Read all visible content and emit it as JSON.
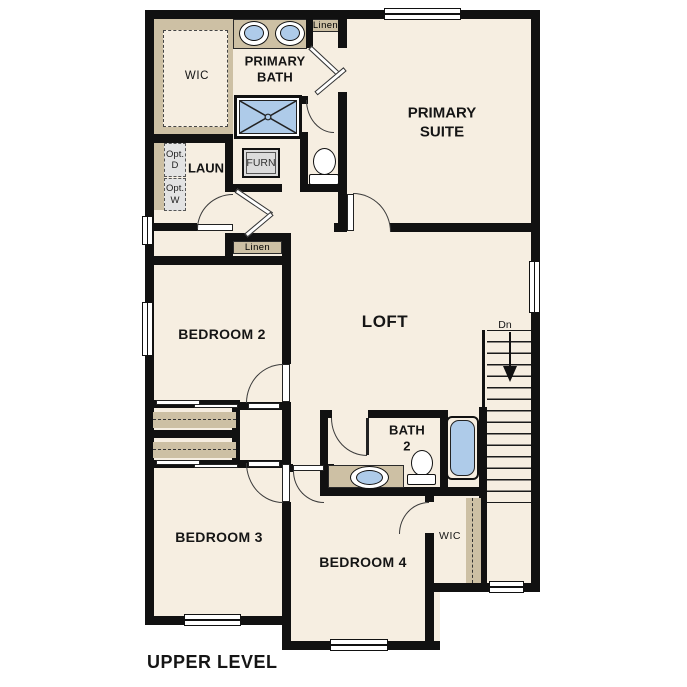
{
  "title": "UPPER LEVEL",
  "colors": {
    "floor": "#f6eee1",
    "wall": "#111111",
    "counter_tan": "#cdc0a4",
    "fixture_blue": "#aecbe9",
    "option_gray": "#e3e3e3"
  },
  "labels": {
    "wic_upper": "WIC",
    "primary_bath_1": "PRIMARY",
    "primary_bath_2": "BATH",
    "linen_top": "Linen",
    "primary_suite_1": "PRIMARY",
    "primary_suite_2": "SUITE",
    "opt_d_1": "Opt.",
    "opt_d_2": "D",
    "opt_w_1": "Opt.",
    "opt_w_2": "W",
    "laundry": "LAUN",
    "furnace": "FURN",
    "linen_hall": "Linen",
    "bedroom2": "BEDROOM 2",
    "loft": "LOFT",
    "stairs_dn": "Dn",
    "bath2_1": "BATH",
    "bath2_2": "2",
    "bedroom3": "BEDROOM 3",
    "bedroom4": "BEDROOM 4",
    "wic_lower": "WIC",
    "floor_title": "UPPER LEVEL"
  }
}
